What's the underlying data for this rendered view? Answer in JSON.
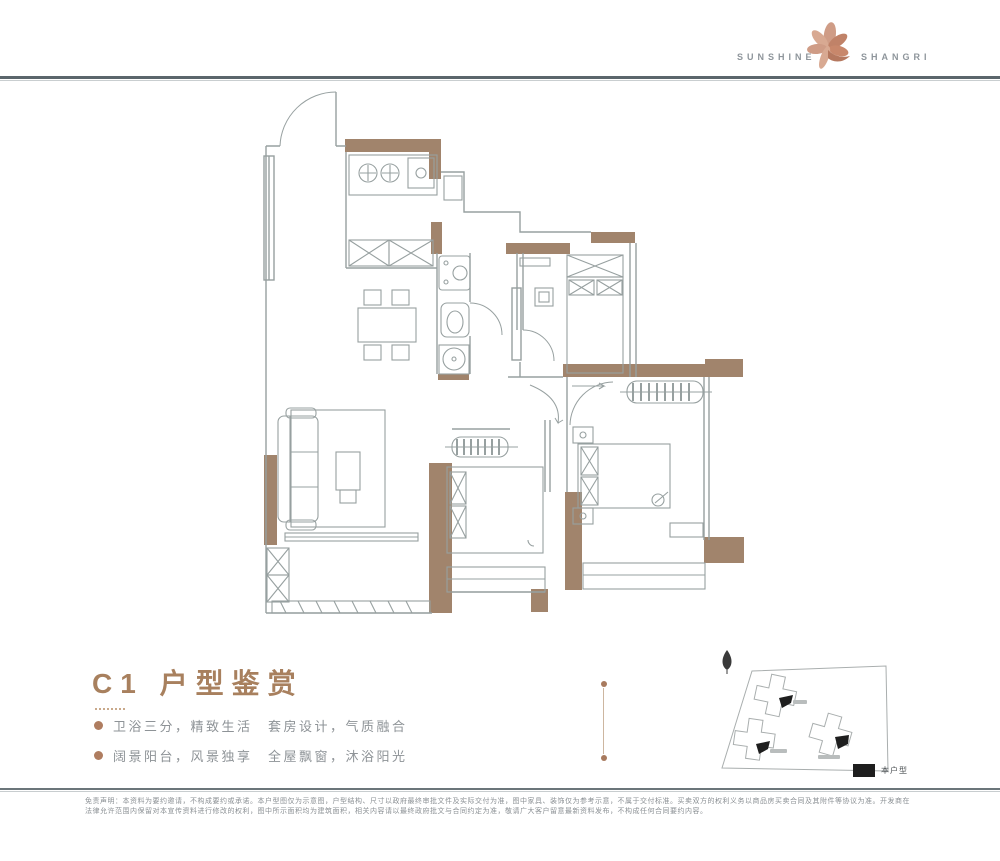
{
  "header": {
    "brand_left": "SUNSHINE",
    "brand_right": "SHANGRI",
    "logo_icon": "rose-gold-flower",
    "rule_color": "#5b666c"
  },
  "title_block": {
    "title": "C1 户型鉴赏",
    "title_color": "#a8805e",
    "bullets": [
      {
        "label": "卫浴三分，精致生活　套房设计，气质融合"
      },
      {
        "label": "阔景阳台，风景独享　全屋飘窗，沐浴阳光"
      }
    ]
  },
  "floor_plan": {
    "wall_accent_color": "#a1846c",
    "line_color": "#97a0a0",
    "rooms": [
      "厨房",
      "餐厅",
      "卫生间",
      "卧室",
      "主卧",
      "客厅",
      "阳台"
    ]
  },
  "site_plan": {
    "compass_icon": "north-arrow",
    "legend_label": "本户型",
    "legend_color": "#1e1e1e",
    "buildings": 3
  },
  "footer": {
    "disclaimer": "免责声明：本资料为要约邀请，不构成要约或承诺。本户型图仅为示意图，户型结构、尺寸以政府最终审批文件及实际交付为准，图中家具、装饰仅为参考示意，不属于交付标准。买卖双方的权利义务以商品房买卖合同及其附件等协议为准。开发商在法律允许范围内保留对本宣传资料进行修改的权利，图中所示面积均为建筑面积，相关内容请以最终政府批文与合同约定为准，敬请广大客户留意最新资料发布，不构成任何合同要约内容。"
  }
}
